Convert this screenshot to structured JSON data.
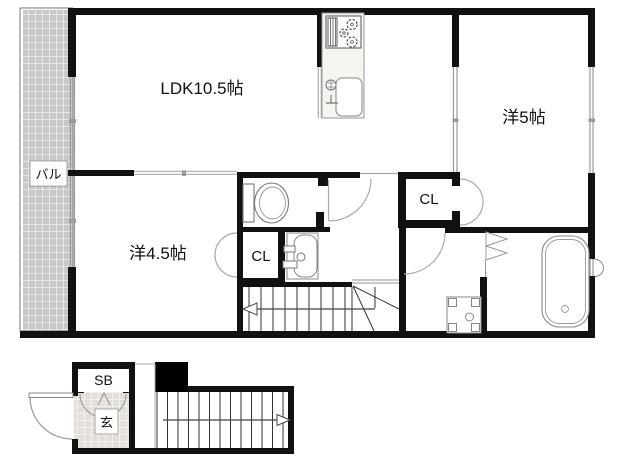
{
  "floor_plan": {
    "labels": {
      "ldk": "LDK10.5帖",
      "western5": "洋5帖",
      "western45": "洋4.5帖",
      "balcony": "バル",
      "closet_main": "CL",
      "closet_bedroom": "CL",
      "shoe_box": "SB",
      "entrance": "玄"
    },
    "colors": {
      "wall": "#111111",
      "balcony_tile": "#c8c8c8",
      "entrance_tile": "#e3e0d9",
      "kitchen_counter": "#f5f4ee",
      "thin_line": "#999999"
    }
  }
}
